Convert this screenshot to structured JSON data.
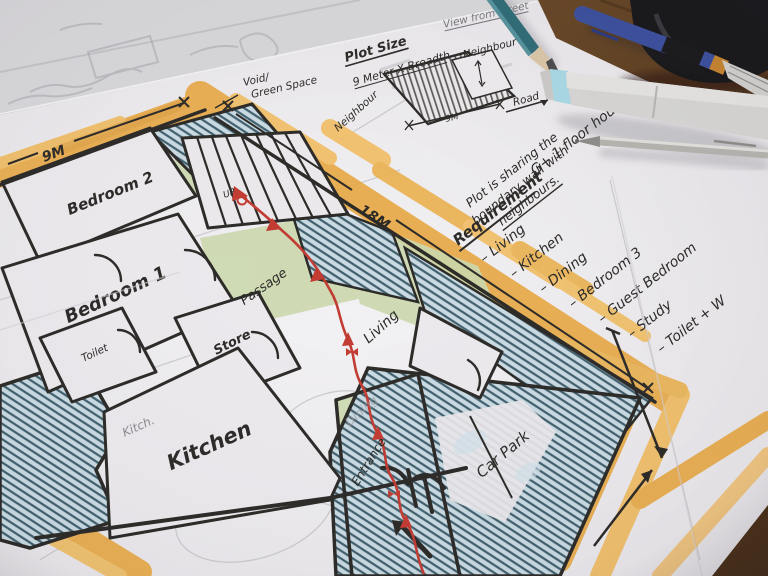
{
  "plan": {
    "labels": {
      "bedroom2": "Bedroom 2",
      "bedroom1": "Bedroom 1",
      "toilet": "Toilet",
      "store": "Store",
      "kitchen": "Kitchen",
      "kitchen_pencil": "Kitch.",
      "dining_pencil": "Dining",
      "passage": "Passage",
      "living": "Living",
      "entrance": "Entrance",
      "carpark": "Car Park",
      "up": "UP",
      "void1": "Void/",
      "void2": "Green Space"
    },
    "dims": {
      "left": "9M",
      "top": "18M"
    }
  },
  "detail": {
    "title": "Plot Size",
    "subtitle": "9 Meter X Breadth",
    "view_note": "View from street",
    "neighbour_left": "Neighbour",
    "neighbour_right": "Neighbour",
    "road": "Road",
    "dim": "9M",
    "note1": "Plot is sharing the",
    "note2": "boundary wall with",
    "note3": "neighbours."
  },
  "requirements": {
    "heading": "Requirement",
    "subheading": "G+ 1 floor house",
    "items": [
      "– Living",
      "– Kitchen",
      "– Dining",
      "– Bedroom 3",
      "– Guest Bedroom",
      "– Study",
      "– Toilet + W"
    ]
  },
  "colors": {
    "marker_orange": "#e7a53e",
    "wash_green": "#cbd8ad",
    "wash_blue": "#c9dae2",
    "ink": "#2b2a27",
    "red_path": "#c23b32",
    "pencil_gray": "#8b8a90"
  }
}
